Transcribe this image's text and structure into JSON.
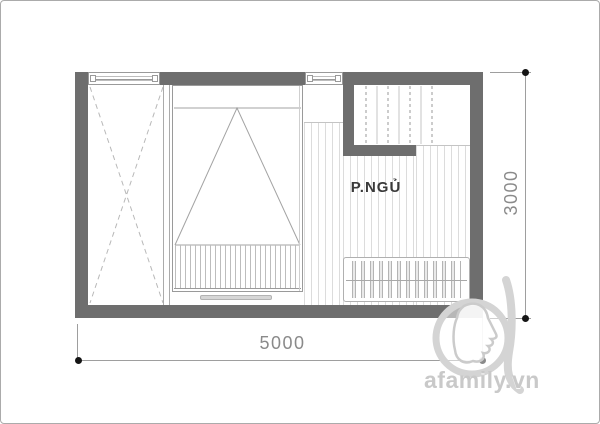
{
  "plan": {
    "room_label": "P.NGỦ",
    "dimension_width_label": "5000",
    "dimension_height_label": "3000",
    "elements": [
      {
        "icon": "wardrobe-icon"
      },
      {
        "icon": "double-bed-icon"
      },
      {
        "icon": "staircase-icon"
      },
      {
        "icon": "clothes-rack-icon"
      },
      {
        "icon": "window-icon"
      },
      {
        "icon": "window-icon"
      }
    ]
  },
  "watermark": {
    "text": "afamily.vn",
    "logo": "afamily-face-logo-icon"
  },
  "colors": {
    "wall": "#6e6e6e",
    "hatch": "#dcdcdc",
    "furniture-line": "#a3a3a3",
    "dim-line": "#9e9e9e",
    "dim-text": "#8a8a8a",
    "dim-dot": "#151515",
    "room-text": "#3a3a3a",
    "watermark-gray": "#c9c9c9"
  }
}
